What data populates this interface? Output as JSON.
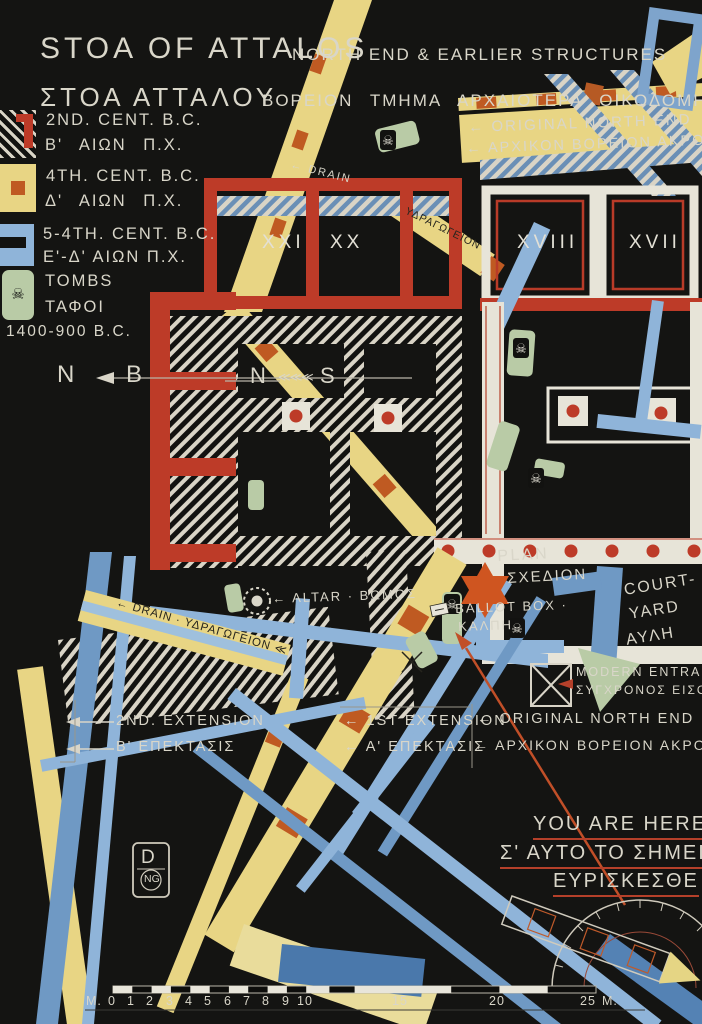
{
  "poster": {
    "title_en": "STOA OF ATTALOS",
    "subtitle_en": "NORTH END & EARLIER STRUCTURES",
    "title_gr": "ΣΤΟΑ ΑΤΤΑΛΟΥ",
    "subtitle_gr": "ΒΟΡΕΙΟΝ ΤΜΗΜΑ ΑΡΧΑΙΟΤΕΡΑ ΟΙΚΟΔΟΜΗΜΑΤΑ",
    "monogram_top": "D",
    "monogram_bottom": "NG"
  },
  "legend": {
    "items": [
      {
        "en": "2ND. CENT. B.C.",
        "gr": "Β' ΑΙΩΝ Π.Χ.",
        "swatch": "hatched-2nd-century"
      },
      {
        "en": "4TH. CENT. B.C.",
        "gr": "Δ' ΑΙΩΝ Π.Χ.",
        "swatch": "yellow-4th-century"
      },
      {
        "en": "5-4TH. CENT. B.C.",
        "gr": "Ε'-Δ' ΑΙΩΝ Π.Χ.",
        "swatch": "blue-5th-4th-century"
      },
      {
        "en": "TOMBS",
        "gr": "ΤΑΦΟΙ",
        "dates": "1400-900 B.C.",
        "swatch": "green-tomb"
      }
    ]
  },
  "compass": {
    "west_en": "N",
    "west_gr": "B",
    "mid_n": "N",
    "mid_chevrons": "≪≪≪",
    "mid_s": "S"
  },
  "rooms": [
    "XXI",
    "XX",
    "XVIII",
    "XVII"
  ],
  "labels": {
    "drain_top": "← DRAIN",
    "aqueduct_top": "ΥΔΡΑΓΩΓΕΙΟΝ",
    "one_top_en": "← ORIGINAL NORTH END",
    "one_top_gr": "← ΑΡΧΙΚΟΝ ΒΟΡΕΙΟΝ ΑΚΡΟΝ",
    "plan_en": "PLAN",
    "plan_gr": "ΣΧΕΔΙΟΝ",
    "altar": "← ALTAR · ΒΩΜΟΣ",
    "ballot_en": "BALLOT BOX ·",
    "ballot_gr": "ΚΑΛΠΗ",
    "courtyard_en_1": "COURT-",
    "courtyard_en_2": "YARD",
    "courtyard_gr": "ΑΥΛΗ",
    "modern_entrance_en": "MODERN ENTRANCE",
    "modern_entrance_gr": "ΣΥΓΧΡΟΝΟΣ ΕΙΣΟΔΟΣ",
    "drain_mid": "← DRAIN · ΥΔΡΑΓΩΓΕΙΟΝ ≪",
    "ext2_en": "2ND. EXTENSION",
    "ext2_gr": "Β' ΕΠΕΚΤΑΣΙΣ",
    "ext1_en": "← 1ST EXTENSION",
    "ext1_gr": "← Α' ΕΠΕΚΤΑΣΙΣ",
    "one_en": "← ORIGINAL NORTH END",
    "one_gr": "← ΑΡΧΙΚΟΝ ΒΟΡΕΙΟΝ ΑΚΡΟΝ",
    "you_are_here_en": "YOU ARE HERE",
    "you_are_here_gr1": "Σ' ΑΥΤΟ ΤΟ ΣΗΜΕΙΟ",
    "you_are_here_gr2": "ΕΥΡΙΣΚΕΣΘΕ"
  },
  "icons": {
    "skull": "☠"
  },
  "scalebar": {
    "labels": [
      "M.",
      "0",
      "1",
      "2",
      "3",
      "4",
      "5",
      "6",
      "7",
      "8",
      "9",
      "10",
      "15",
      "20",
      "25",
      "M."
    ]
  },
  "colors": {
    "background": "#141412",
    "ink": "#d9d6c9",
    "red_walls": "#bd3b28",
    "yellow_roads": "#e8d584",
    "orange_dashes": "#bf5a22",
    "blue_light": "#8fb4d9",
    "blue_mid": "#6f99c4",
    "green_tombs": "#b9cba6",
    "star_orange": "#cf5520"
  }
}
